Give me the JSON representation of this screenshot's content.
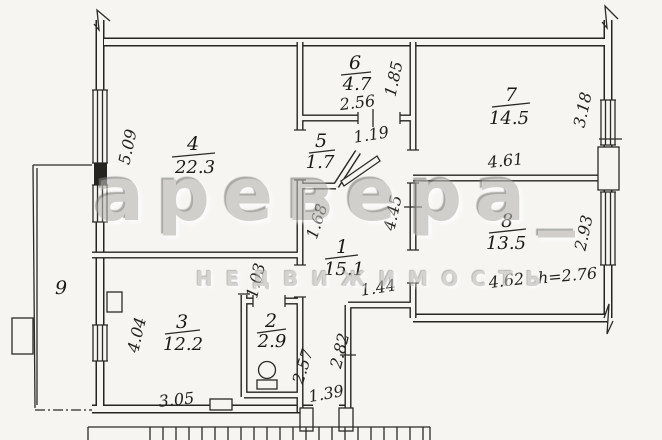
{
  "watermark": {
    "brand": "аревера_",
    "subtitle": "НЕДВИЖИМОСТЬ"
  },
  "rooms": {
    "r1": {
      "number": "1",
      "area": "15.1"
    },
    "r2": {
      "number": "2",
      "area": "2.9"
    },
    "r3": {
      "number": "3",
      "area": "12.2"
    },
    "r4": {
      "number": "4",
      "area": "22.3"
    },
    "r5": {
      "number": "5",
      "area": "1.7"
    },
    "r6": {
      "number": "6",
      "area": "4.7"
    },
    "r7": {
      "number": "7",
      "area": "14.5"
    },
    "r8": {
      "number": "8",
      "area": "13.5"
    },
    "r9": {
      "number": "9"
    }
  },
  "dimensions": {
    "room4_height": "5.09",
    "room6_width": "2.56",
    "room6_depth": "1.85",
    "passage_width": "1.19",
    "room7_width": "4.61",
    "room7_depth": "3.18",
    "hall_upper": "1.68",
    "hall_right": "4.45",
    "hall_step": "1.44",
    "room8_width": "4.62",
    "room8_depth": "2.93",
    "ceiling_height": "h=2.76",
    "niche_depth": "1.03",
    "room3_height": "4.04",
    "room3_width": "3.05",
    "corridor_left": "2.57",
    "corridor_right": "2.82",
    "entry_width": "1.39"
  }
}
